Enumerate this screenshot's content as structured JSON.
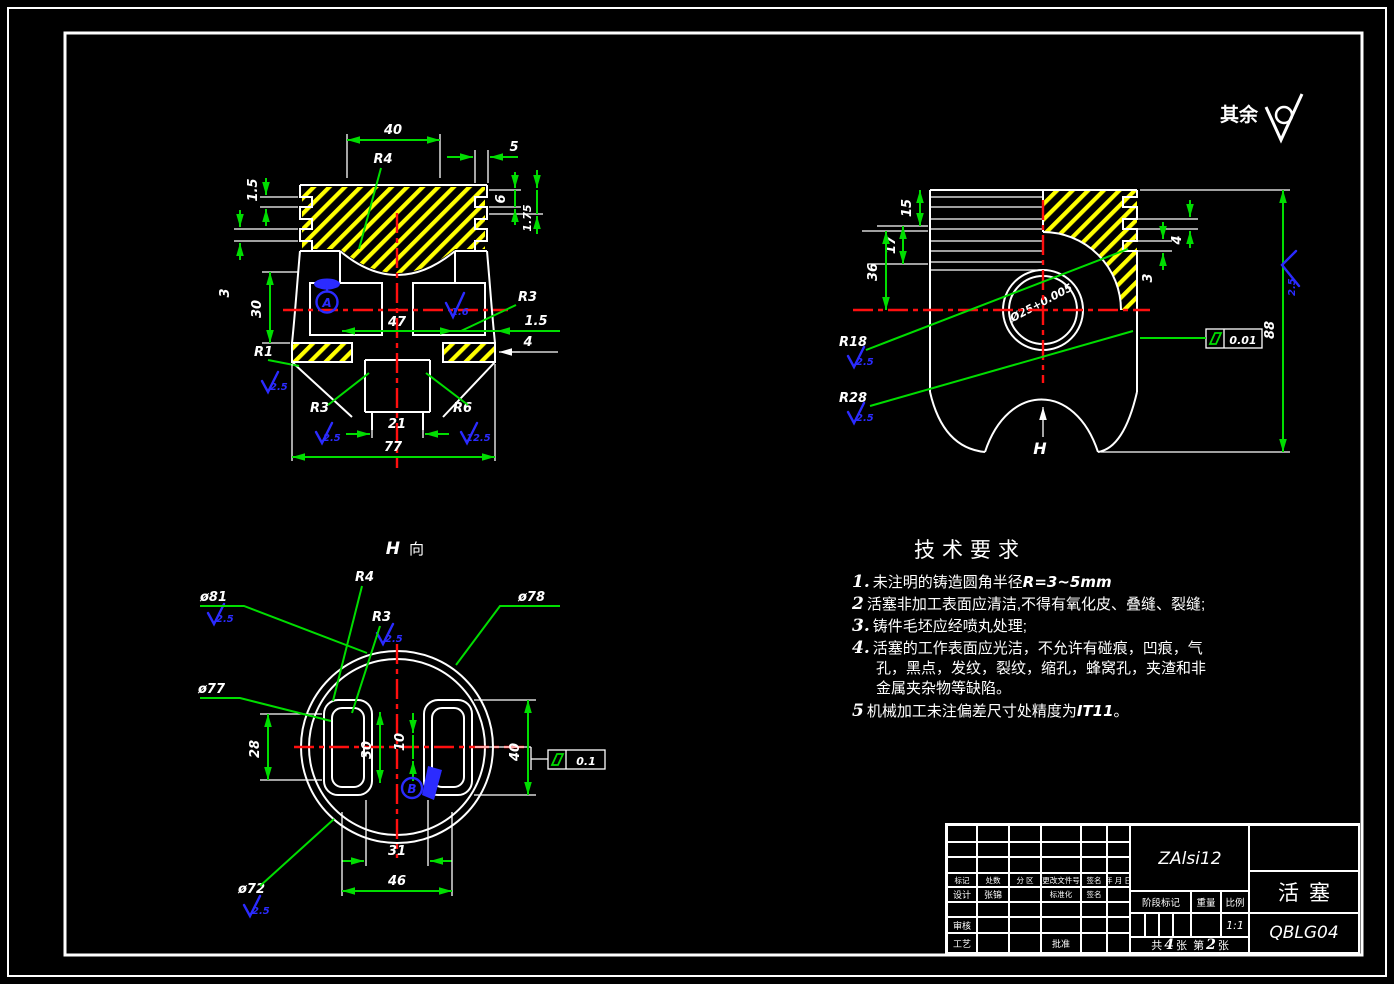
{
  "corner": {
    "label": "其余"
  },
  "front": {
    "d40": "40",
    "r4": "R4",
    "d5": "5",
    "d6": "6",
    "d175": "1.75",
    "d15l": "1.5",
    "d3l": "3",
    "d30": "30",
    "d47": "47",
    "d15r": "1.5",
    "d4r": "4",
    "r3r": "R3",
    "r1": "R1",
    "rough_r1": "2.5",
    "datum": "A",
    "rough_win": "1.6",
    "r3b": "R3",
    "rough_r3b": "2.5",
    "r6b": "R6",
    "rough_r6b": "12.5",
    "d21": "21",
    "d77": "77"
  },
  "side": {
    "d15": "15",
    "d17": "17",
    "d36": "36",
    "d4": "4",
    "d3": "3",
    "d88": "88",
    "bore": "Ø25+0.005",
    "tol": "0.01",
    "r18": "R18",
    "rough_r18": "2.5",
    "r28": "R28",
    "rough_r28": "2.5",
    "rough_side": "2.5",
    "h": "H"
  },
  "hview": {
    "h": "H",
    "xiang": "向",
    "phi81": "ø81",
    "rough81": "2.5",
    "r4": "R4",
    "r3": "R3",
    "roughr3": "2.5",
    "phi78": "ø78",
    "phi77": "ø77",
    "phi72": "ø72",
    "rough72": "2.5",
    "d28": "28",
    "d30": "30",
    "d10": "10",
    "d40": "40",
    "d31": "31",
    "d46": "46",
    "tol": "0.1",
    "datum": "B"
  },
  "tech": {
    "title": "技术要求",
    "items": [
      {
        "no": "1.",
        "text": "未注明的铸造圆角半径",
        "em": "R=3~5mm",
        "tail": ""
      },
      {
        "no": "2",
        "text": "活塞非加工表面应清洁,不得有氧化皮、叠缝、裂缝;",
        "em": "",
        "tail": ""
      },
      {
        "no": "3.",
        "text": "铸件毛坯应经喷丸处理;",
        "em": "",
        "tail": ""
      },
      {
        "no": "4.",
        "text": "活塞的工作表面应光洁，不允许有碰痕，凹痕，气孔，黑点，发纹，裂纹，缩孔，蜂窝孔，夹渣和非金属夹杂物等缺陷。",
        "em": "",
        "tail": ""
      },
      {
        "no": "5",
        "text": "机械加工未注偏差尺寸处精度为",
        "em": "IT11",
        "tail": "。"
      }
    ]
  },
  "tb": {
    "material": "ZAlsi12",
    "part": "活塞",
    "code": "QBLG04",
    "biaoji": "标记",
    "chushu": "处数",
    "fenqu": "分 区",
    "wenjianhao": "更改文件号",
    "qianming": "签名",
    "riqi": "年 月 日",
    "sheji": "设计",
    "designer": "张锦",
    "biaozhunhua": "标准化",
    "qianming2": "签名",
    "shenhe": "审核",
    "gongyi": "工艺",
    "pizhun": "批准",
    "jieduan": "阶段标记",
    "zhongliang": "重量",
    "bili": "比例",
    "scale": "1:1",
    "gong": "共",
    "total": "4",
    "zhang": "张",
    "di": "第",
    "num": "2",
    "zhang2": "张"
  }
}
